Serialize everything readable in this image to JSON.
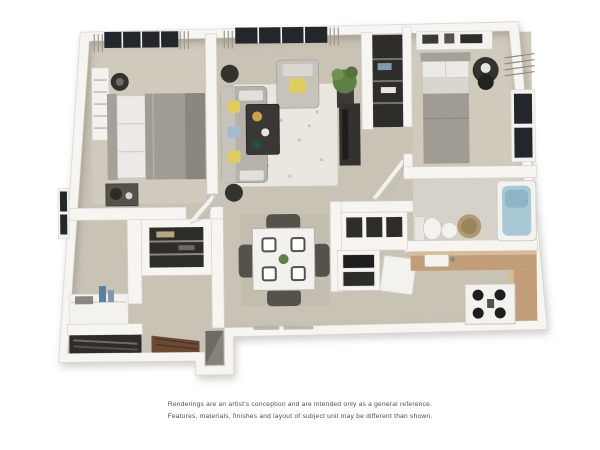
{
  "page": {
    "background_color": "#ffffff",
    "content_type": "3d-apartment-floor-plan-rendering"
  },
  "disclaimer": {
    "line1": "Renderings are an artist's conception and are intended only as a general reference.",
    "line2": "Features, materials, finishes and layout of subject unit may be different than shown."
  },
  "floorplan": {
    "style": "top-down 3d render, two bedroom one bath apartment",
    "rooms": [
      "master-bedroom",
      "living-room",
      "dining-area",
      "kitchen",
      "second-bedroom",
      "bathroom",
      "dressing-area",
      "entry-hall",
      "linen-closet",
      "shoe-closet",
      "hall-closet"
    ],
    "furniture": [
      "master-bed",
      "master-dresser",
      "nightstand",
      "table-lamp",
      "sofa-with-pillows",
      "armchair",
      "coffee-table",
      "area-rug",
      "tv-console",
      "potted-plant",
      "floor-speakers",
      "dining-table-with-four-chairs",
      "place-settings",
      "second-bed",
      "bedroom-dresser",
      "accent-chair",
      "bathtub",
      "toilet",
      "laundry-basket",
      "kitchen-counter",
      "stove",
      "dishwasher",
      "upper-cabinets",
      "appliance-cabinet",
      "sink",
      "vanity-counter",
      "entry-steps"
    ],
    "palette": {
      "floor": "#c9c3b6",
      "walls": "#f7f5f2",
      "wall_shadow": "#d7d3cc",
      "dark_furniture": "#34322e",
      "bedding_gray": "#a09c94",
      "counter_wood": "#c29e78",
      "bathtub_blue": "#a9c8d6",
      "accent_yellow": "#ddce5f",
      "accent_blue": "#a3bccd",
      "plant_green": "#5f8044",
      "steps_brown": "#6b4a33",
      "window_glass": "#23262a"
    }
  }
}
